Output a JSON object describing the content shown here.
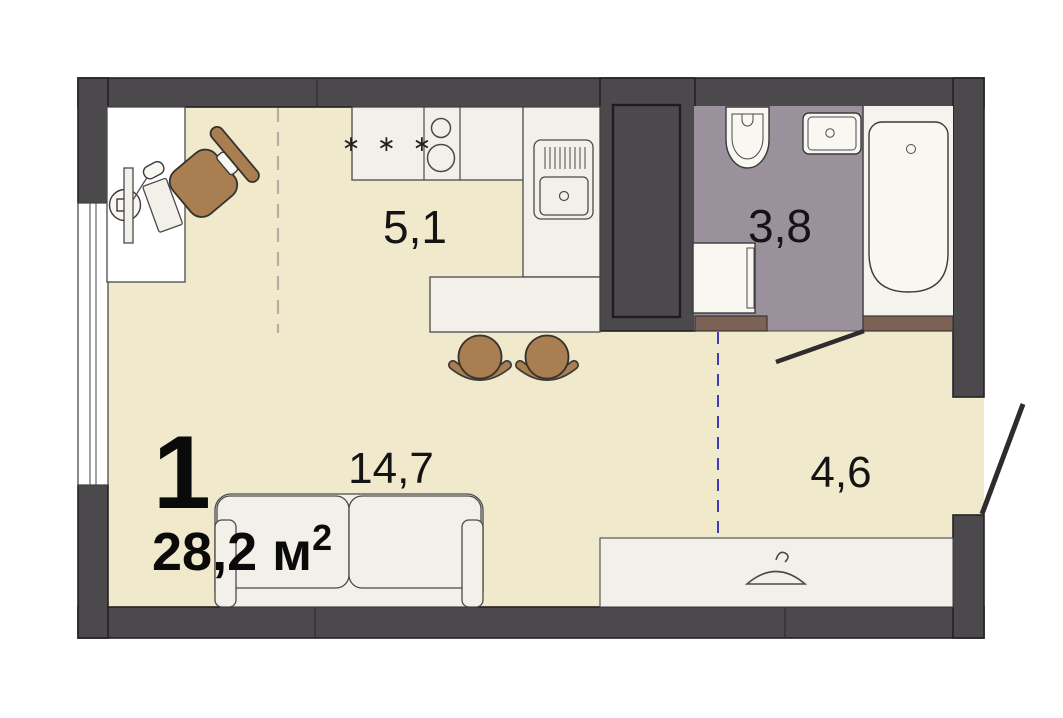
{
  "plan": {
    "rooms_count": "1",
    "total_area": "28,2 м",
    "total_area_sup": "2",
    "areas": {
      "kitchen": "5,1",
      "bathroom": "3,8",
      "living_room": "14,7",
      "hallway": "4,6"
    },
    "stove_marks": "∗ ∗ ∗"
  },
  "colors": {
    "background": "#ffffff",
    "wall": "#4b494c",
    "floor": "#f1e9cc",
    "bathroom_floor": "#9b919d",
    "bath_niche_floor": "#f4f3ed",
    "furniture": "#f2f0e9",
    "desk_white": "#ffffff",
    "fixture_white": "#f8f7f2",
    "threshold_wood": "#7c6254",
    "chair_brown": "#a97e51",
    "door_leaf": "#2e2c2e",
    "zone_divider_gray": "#b3afa6",
    "zone_divider_blue": "#403cb4",
    "label_text": "#141414"
  }
}
